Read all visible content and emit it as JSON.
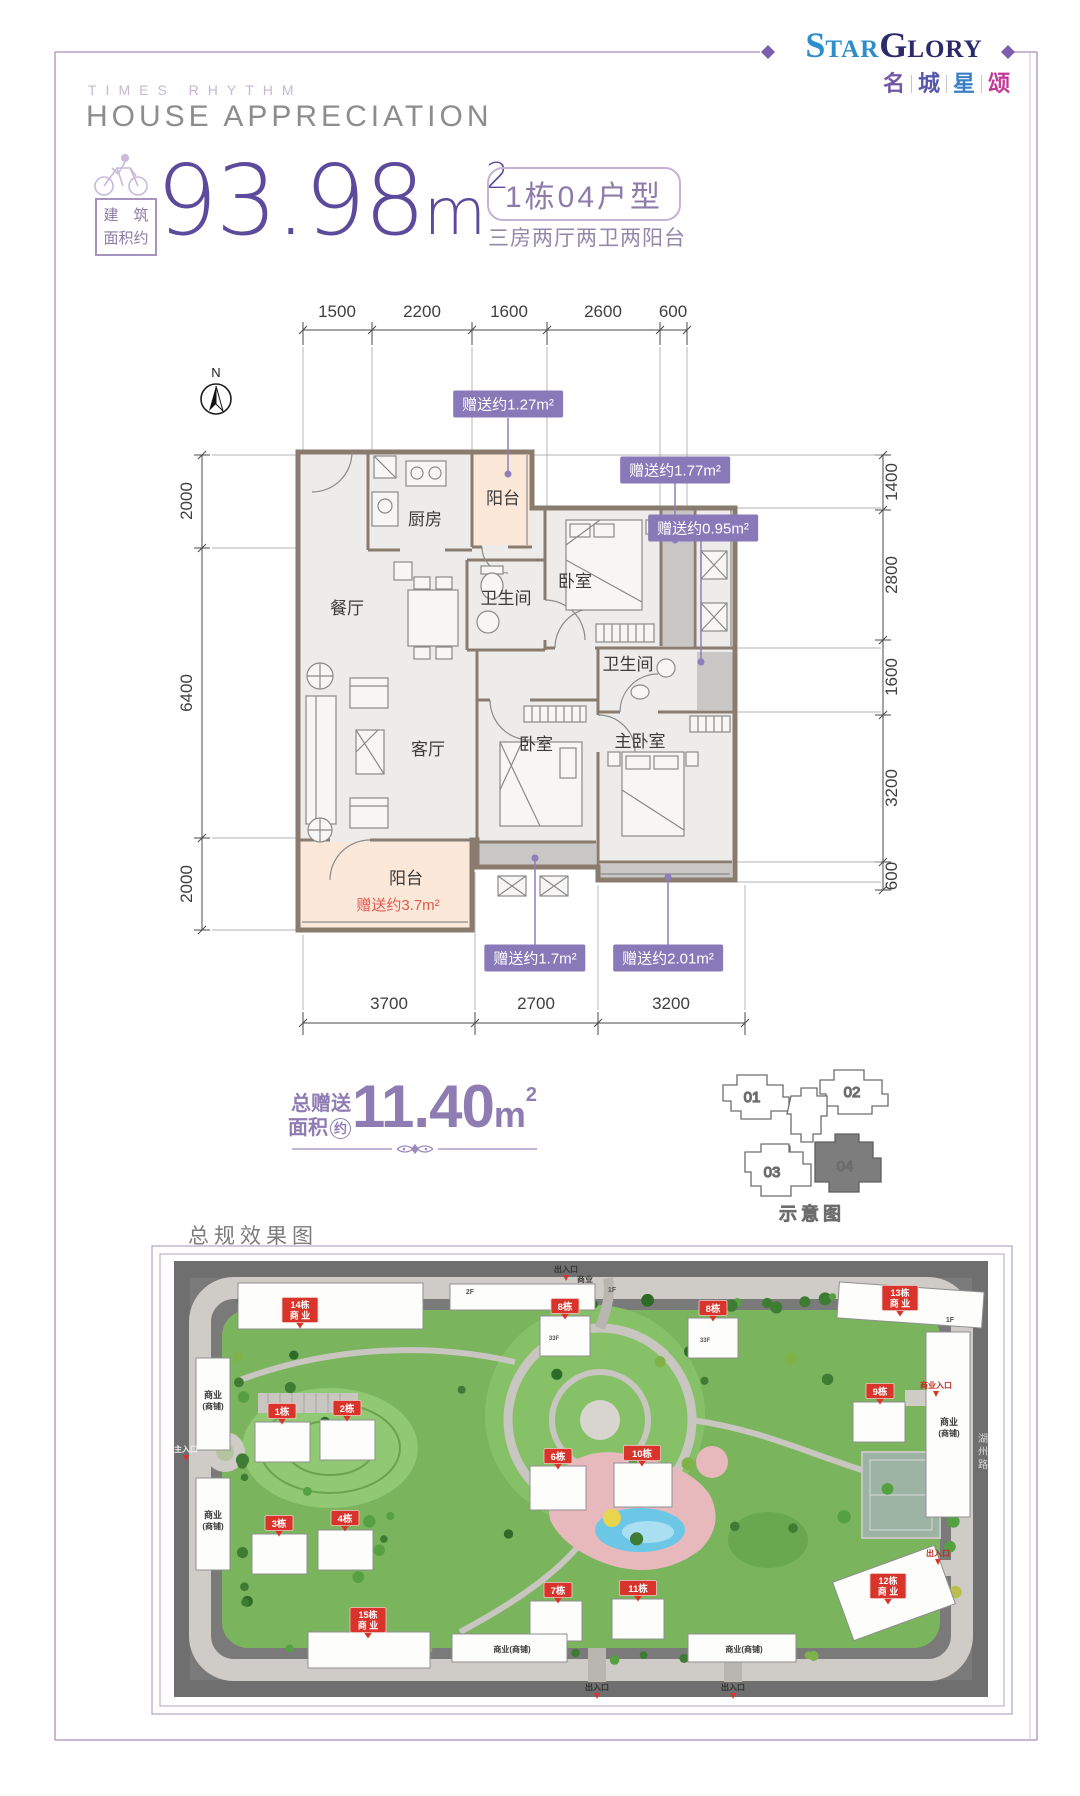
{
  "brand": {
    "en": {
      "p1": "S",
      "p2": "TAR",
      "p3": "G",
      "p4": "LORY"
    },
    "cn": [
      "名",
      "城",
      "星",
      "颂"
    ]
  },
  "header": {
    "kicker": "TIMES RHYTHM",
    "title": "HOUSE APPRECIATION"
  },
  "area": {
    "tag1": "建　筑",
    "tag2": "面积约",
    "value": "93.98",
    "unit": "m",
    "sup": "2"
  },
  "unit": {
    "badge": "1栋04户型",
    "subtitle": "三房两厅两卫两阳台"
  },
  "north": "N",
  "dims": {
    "top": [
      "1500",
      "2200",
      "1600",
      "2600",
      "600"
    ],
    "left": [
      "2000",
      "6400",
      "2000"
    ],
    "right": [
      "1400",
      "2800",
      "1600",
      "3200",
      "600"
    ],
    "bottom": [
      "3700",
      "2700",
      "3200"
    ]
  },
  "rooms": {
    "kitchen": "厨房",
    "balcony_top": "阳台",
    "bedroom_top": "卧室",
    "bath_mid": "卫生间",
    "dining": "餐厅",
    "living": "客厅",
    "bedroom_mid": "卧室",
    "master": "主卧室",
    "bath_right": "卫生间",
    "balcony_bottom": "阳台",
    "balcony_gift": "赠送约3.7m²"
  },
  "gifts": [
    "赠送约1.27m²",
    "赠送约1.77m²",
    "赠送约0.95m²",
    "赠送约1.7m²",
    "赠送约2.01m²"
  ],
  "total": {
    "t1": "总赠送",
    "t2": "面积",
    "circle": "约",
    "value": "11.40",
    "unit": "m",
    "sup": "2"
  },
  "keyplan": {
    "units": [
      "01",
      "02",
      "03",
      "04"
    ],
    "caption": "示意图"
  },
  "siteplan": {
    "caption": "总规效果图",
    "colors": {
      "badge": "#d9342b",
      "green": "#7ab45c",
      "road": "#cfccc8",
      "bg": "#6f6f6f",
      "pink": "#e8b9bc",
      "pool": "#6cc6e6"
    },
    "badges": [
      {
        "l1": "14栋",
        "l2": "商 业",
        "x": 300,
        "y": 1310
      },
      {
        "l1": "8栋",
        "x": 565,
        "y": 1306
      },
      {
        "l1": "8栋",
        "x": 713,
        "y": 1308
      },
      {
        "l1": "13栋",
        "l2": "商 业",
        "x": 900,
        "y": 1298
      },
      {
        "l1": "1栋",
        "x": 282,
        "y": 1411
      },
      {
        "l1": "2栋",
        "x": 347,
        "y": 1408
      },
      {
        "l1": "9栋",
        "x": 880,
        "y": 1391
      },
      {
        "l1": "6栋",
        "x": 558,
        "y": 1456
      },
      {
        "l1": "10栋",
        "x": 642,
        "y": 1453
      },
      {
        "l1": "3栋",
        "x": 279,
        "y": 1523
      },
      {
        "l1": "4栋",
        "x": 345,
        "y": 1518
      },
      {
        "l1": "7栋",
        "x": 558,
        "y": 1590
      },
      {
        "l1": "11栋",
        "x": 638,
        "y": 1588
      },
      {
        "l1": "12栋",
        "l2": "商 业",
        "x": 888,
        "y": 1586
      },
      {
        "l1": "15栋",
        "l2": "商 业",
        "x": 368,
        "y": 1620
      }
    ],
    "labels": [
      {
        "t": "商业",
        "x": 213,
        "y": 1398,
        "s": 9,
        "c": "#3c3c3c"
      },
      {
        "t": "(商铺)",
        "x": 213,
        "y": 1409,
        "s": 8,
        "c": "#3c3c3c"
      },
      {
        "t": "商业",
        "x": 213,
        "y": 1518,
        "s": 9,
        "c": "#3c3c3c"
      },
      {
        "t": "(商铺)",
        "x": 213,
        "y": 1529,
        "s": 8,
        "c": "#3c3c3c"
      },
      {
        "t": "商业",
        "x": 949,
        "y": 1425,
        "s": 9,
        "c": "#3c3c3c"
      },
      {
        "t": "(商铺)",
        "x": 949,
        "y": 1436,
        "s": 8,
        "c": "#3c3c3c"
      },
      {
        "t": "商业(商铺)",
        "x": 512,
        "y": 1652,
        "s": 8,
        "c": "#3c3c3c"
      },
      {
        "t": "商业(商铺)",
        "x": 744,
        "y": 1652,
        "s": 8,
        "c": "#3c3c3c"
      },
      {
        "t": "商业",
        "x": 585,
        "y": 1282,
        "s": 8,
        "c": "#3c3c3c"
      },
      {
        "t": "2F",
        "x": 470,
        "y": 1294,
        "s": 7,
        "c": "#555555"
      },
      {
        "t": "1F",
        "x": 612,
        "y": 1292,
        "s": 7,
        "c": "#555555"
      },
      {
        "t": "1F",
        "x": 950,
        "y": 1322,
        "s": 7,
        "c": "#555555"
      },
      {
        "t": "33F",
        "x": 554,
        "y": 1340,
        "s": 6,
        "c": "#555555"
      },
      {
        "t": "33F",
        "x": 705,
        "y": 1342,
        "s": 6,
        "c": "#555555"
      },
      {
        "t": "湖州路",
        "x": 983,
        "y": 1442,
        "s": 10,
        "c": "#d8d8d8",
        "v": true
      }
    ],
    "entrances": [
      {
        "t": "出入口",
        "x": 566,
        "y": 1272,
        "c": "#333333"
      },
      {
        "t": "商业入口",
        "x": 936,
        "y": 1388,
        "c": "#c02b22"
      },
      {
        "t": "出入口",
        "x": 938,
        "y": 1556,
        "c": "#c02b22"
      },
      {
        "t": "主入口",
        "x": 186,
        "y": 1452,
        "c": "#eeeeee"
      },
      {
        "t": "出入口",
        "x": 597,
        "y": 1690,
        "c": "#333333"
      },
      {
        "t": "出入口",
        "x": 733,
        "y": 1690,
        "c": "#333333"
      }
    ],
    "buildings": [
      [
        238,
        1283,
        185,
        46,
        0
      ],
      [
        450,
        1284,
        145,
        26,
        0
      ],
      [
        540,
        1316,
        50,
        40,
        0
      ],
      [
        688,
        1318,
        50,
        40,
        0
      ],
      [
        838,
        1287,
        145,
        36,
        4
      ],
      [
        255,
        1422,
        55,
        40,
        0
      ],
      [
        320,
        1420,
        55,
        40,
        0
      ],
      [
        196,
        1358,
        34,
        92,
        0
      ],
      [
        196,
        1478,
        34,
        92,
        0
      ],
      [
        853,
        1402,
        52,
        40,
        0
      ],
      [
        926,
        1332,
        44,
        185,
        0
      ],
      [
        530,
        1466,
        56,
        44,
        0
      ],
      [
        614,
        1463,
        58,
        44,
        0
      ],
      [
        252,
        1534,
        55,
        40,
        0
      ],
      [
        318,
        1530,
        55,
        40,
        0
      ],
      [
        530,
        1601,
        52,
        40,
        0
      ],
      [
        612,
        1599,
        52,
        40,
        0
      ],
      [
        840,
        1562,
        108,
        62,
        -20
      ],
      [
        308,
        1632,
        122,
        36,
        0
      ],
      [
        452,
        1634,
        115,
        28,
        0
      ],
      [
        688,
        1634,
        108,
        28,
        0
      ]
    ]
  }
}
